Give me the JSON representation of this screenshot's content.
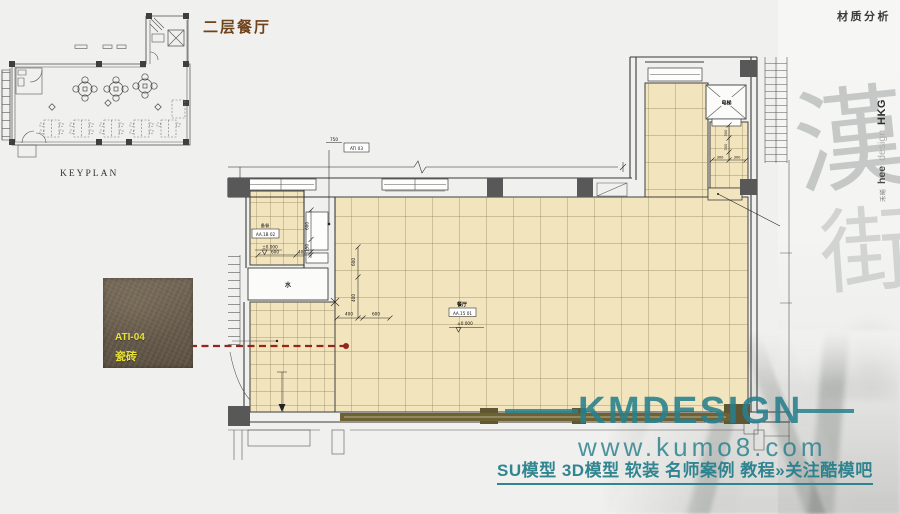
{
  "page": {
    "title": "二层餐厅",
    "corner_label": "材质分析",
    "keyplan_label": "KEYPLAN"
  },
  "branding": {
    "studio_cn": "禾晞",
    "studio_en_bold": "hee",
    "studio_en_light": "design",
    "studio_region": "HKG",
    "calligraphy_1": "漢",
    "calligraphy_2": "街"
  },
  "material_swatch": {
    "code": "ATI-04",
    "name": "瓷砖"
  },
  "plan": {
    "dining_label": "餐厅",
    "dining_code": "AA.15 01",
    "dining_level": "±0.000",
    "pantry_name": "备餐",
    "pantry_code": "AA.1B 02",
    "pantry_level": "±0.000",
    "elevator_label": "电梯",
    "water_label": "水",
    "finish_leader": {
      "dim": "750",
      "code": "ATI 03"
    },
    "dims": {
      "hall_v_600": "600",
      "hall_v_400": "400",
      "hall_h_400": "400",
      "hall_h_600": "600",
      "pantry_v_600": "600",
      "pantry_v_150": "150",
      "pantry_h_600": "600",
      "pantry_h_400": "400",
      "lift_v_300a": "300",
      "lift_v_300b": "300",
      "lift_h_300a": "300",
      "lift_h_300b": "300"
    }
  },
  "watermark": {
    "brand": "KMDESIGN",
    "url": "www.kumo8.com",
    "tagline": "SU模型 3D模型 软装 名师案例 教程»关注酷模吧"
  },
  "colors": {
    "tile_fill": "#f2e4bc",
    "tile_line": "#7a6b45",
    "wall": "#3a3a3a",
    "column_gray": "#585858",
    "column_olive": "#5f5634",
    "storefront": "#6e6233",
    "leader_red": "#96251a",
    "title_brown": "#6f431c",
    "teal": "#27808d",
    "swatch_bg": "#6b5e4d",
    "swatch_label": "#e8e436"
  }
}
